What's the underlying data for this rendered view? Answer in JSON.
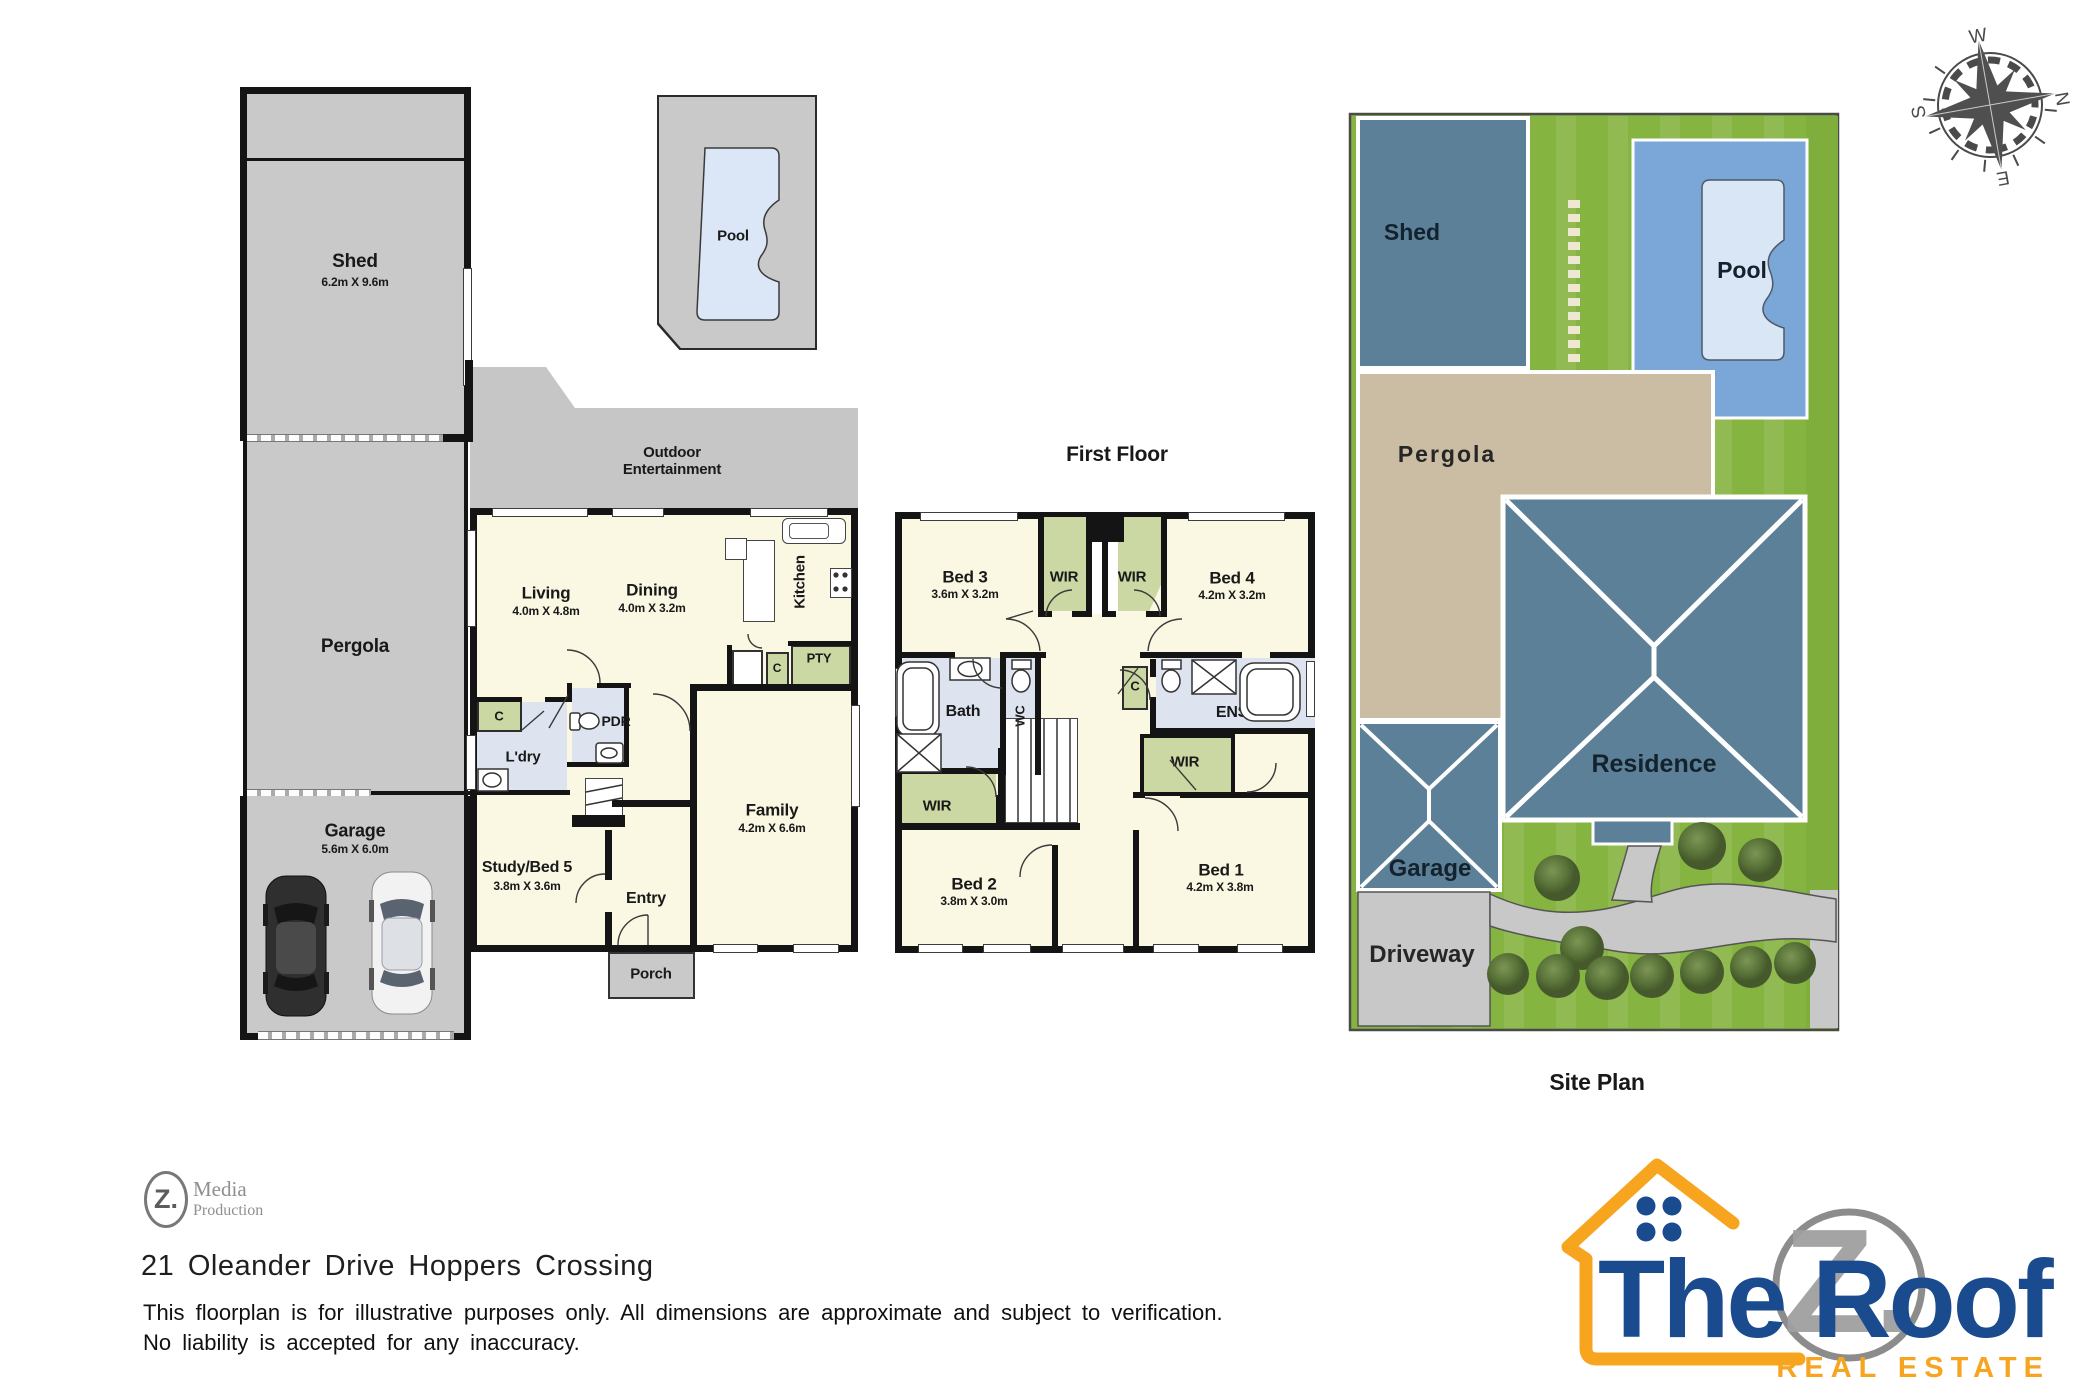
{
  "ground_floor": {
    "shed": {
      "label": "Shed",
      "dims": "6.2m X 9.6m"
    },
    "pergola": {
      "label": "Pergola"
    },
    "garage": {
      "label": "Garage",
      "dims": "5.6m X 6.0m"
    },
    "pool": {
      "label": "Pool"
    },
    "outdoor": {
      "label_line1": "Outdoor",
      "label_line2": "Entertainment"
    },
    "living": {
      "label": "Living",
      "dims": "4.0m X 4.8m"
    },
    "dining": {
      "label": "Dining",
      "dims": "4.0m X 3.2m"
    },
    "kitchen": {
      "label": "Kitchen"
    },
    "pantry": {
      "label": "PTY"
    },
    "closet_kitchen": {
      "label": "C"
    },
    "closet_hall": {
      "label": "C"
    },
    "laundry": {
      "label": "L'dry"
    },
    "powder": {
      "label": "PDR"
    },
    "study": {
      "label": "Study/Bed 5",
      "dims": "3.8m X 3.6m"
    },
    "entry": {
      "label": "Entry"
    },
    "family": {
      "label": "Family",
      "dims": "4.2m X 6.6m"
    },
    "porch": {
      "label": "Porch"
    }
  },
  "first_floor": {
    "title": "First Floor",
    "bed3": {
      "label": "Bed 3",
      "dims": "3.6m X 3.2m"
    },
    "bed4": {
      "label": "Bed 4",
      "dims": "4.2m X 3.2m"
    },
    "wir": {
      "label": "WIR"
    },
    "bath": {
      "label": "Bath"
    },
    "wc": {
      "label": "WC"
    },
    "closet": {
      "label": "C"
    },
    "ens": {
      "label": "ENS"
    },
    "bed2": {
      "label": "Bed 2",
      "dims": "3.8m X 3.0m"
    },
    "bed1": {
      "label": "Bed 1",
      "dims": "4.2m X 3.8m"
    }
  },
  "site_plan": {
    "title": "Site Plan",
    "shed": "Shed",
    "pool": "Pool",
    "pergola": "Pergola",
    "residence": "Residence",
    "garage": "Garage",
    "driveway": "Driveway"
  },
  "compass": {
    "west": "W",
    "north": "N",
    "east": "E",
    "south": "S"
  },
  "footer": {
    "media_logo": {
      "monogram": "Z.",
      "line1": "Media",
      "line2": "Production"
    },
    "address": "21 Oleander Drive Hoppers Crossing",
    "disclaimer_line1": "This floorplan is for illustrative purposes only. All dimensions are approximate and subject to verification.",
    "disclaimer_line2": "No liability is accepted for any inaccuracy."
  },
  "brand": {
    "name": "The Roof",
    "monogram": "Z.",
    "tagline": "REAL ESTATE"
  },
  "colors": {
    "floor_gray": "#c9c9c9",
    "wall": "#141414",
    "room_cream": "#faf7e3",
    "wet_blue": "#dde4f0",
    "closet_green": "#ccd8a4",
    "pool_water": "#dbe7f6",
    "site_grass": "#86b441",
    "site_roof": "#5d8099",
    "site_pergola": "#cbbda3",
    "site_pool": "#7aa7d8",
    "paving_gray": "#c8c8c8",
    "brand_orange": "#f7a41f",
    "brand_navy": "#1a4b8f"
  }
}
